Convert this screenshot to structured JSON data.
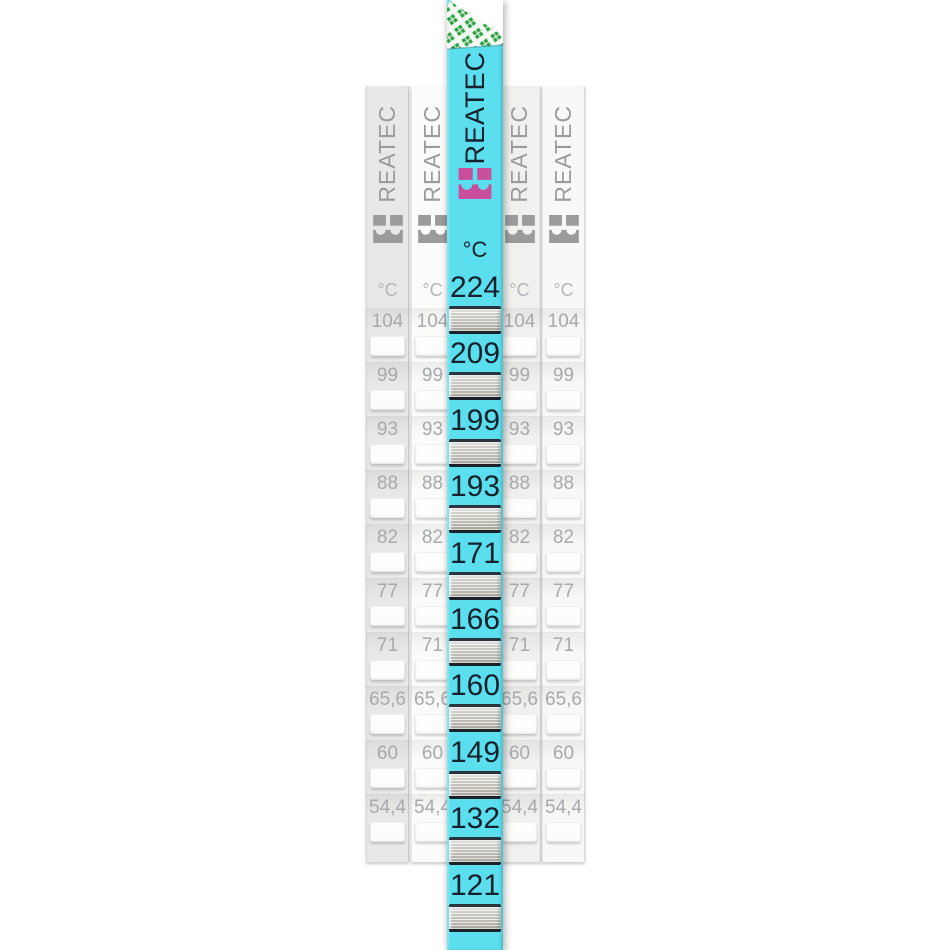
{
  "brand": "REATEC",
  "unit_label": "°C",
  "cyan_strip": {
    "temps": [
      "224",
      "209",
      "199",
      "193",
      "171",
      "166",
      "160",
      "149",
      "132",
      "121"
    ]
  },
  "background_strips": {
    "count": 4,
    "temps": [
      "104",
      "99",
      "93",
      "88",
      "82",
      "77",
      "71",
      "65,6",
      "60",
      "54,4"
    ]
  },
  "colors": {
    "cyan": "#5BDFEE",
    "dark_text": "#15212C",
    "pink": "#C94F9D",
    "green": "#2FA246",
    "gray_text": "#A6AAAC",
    "gray_logo": "#9B9B9B"
  }
}
